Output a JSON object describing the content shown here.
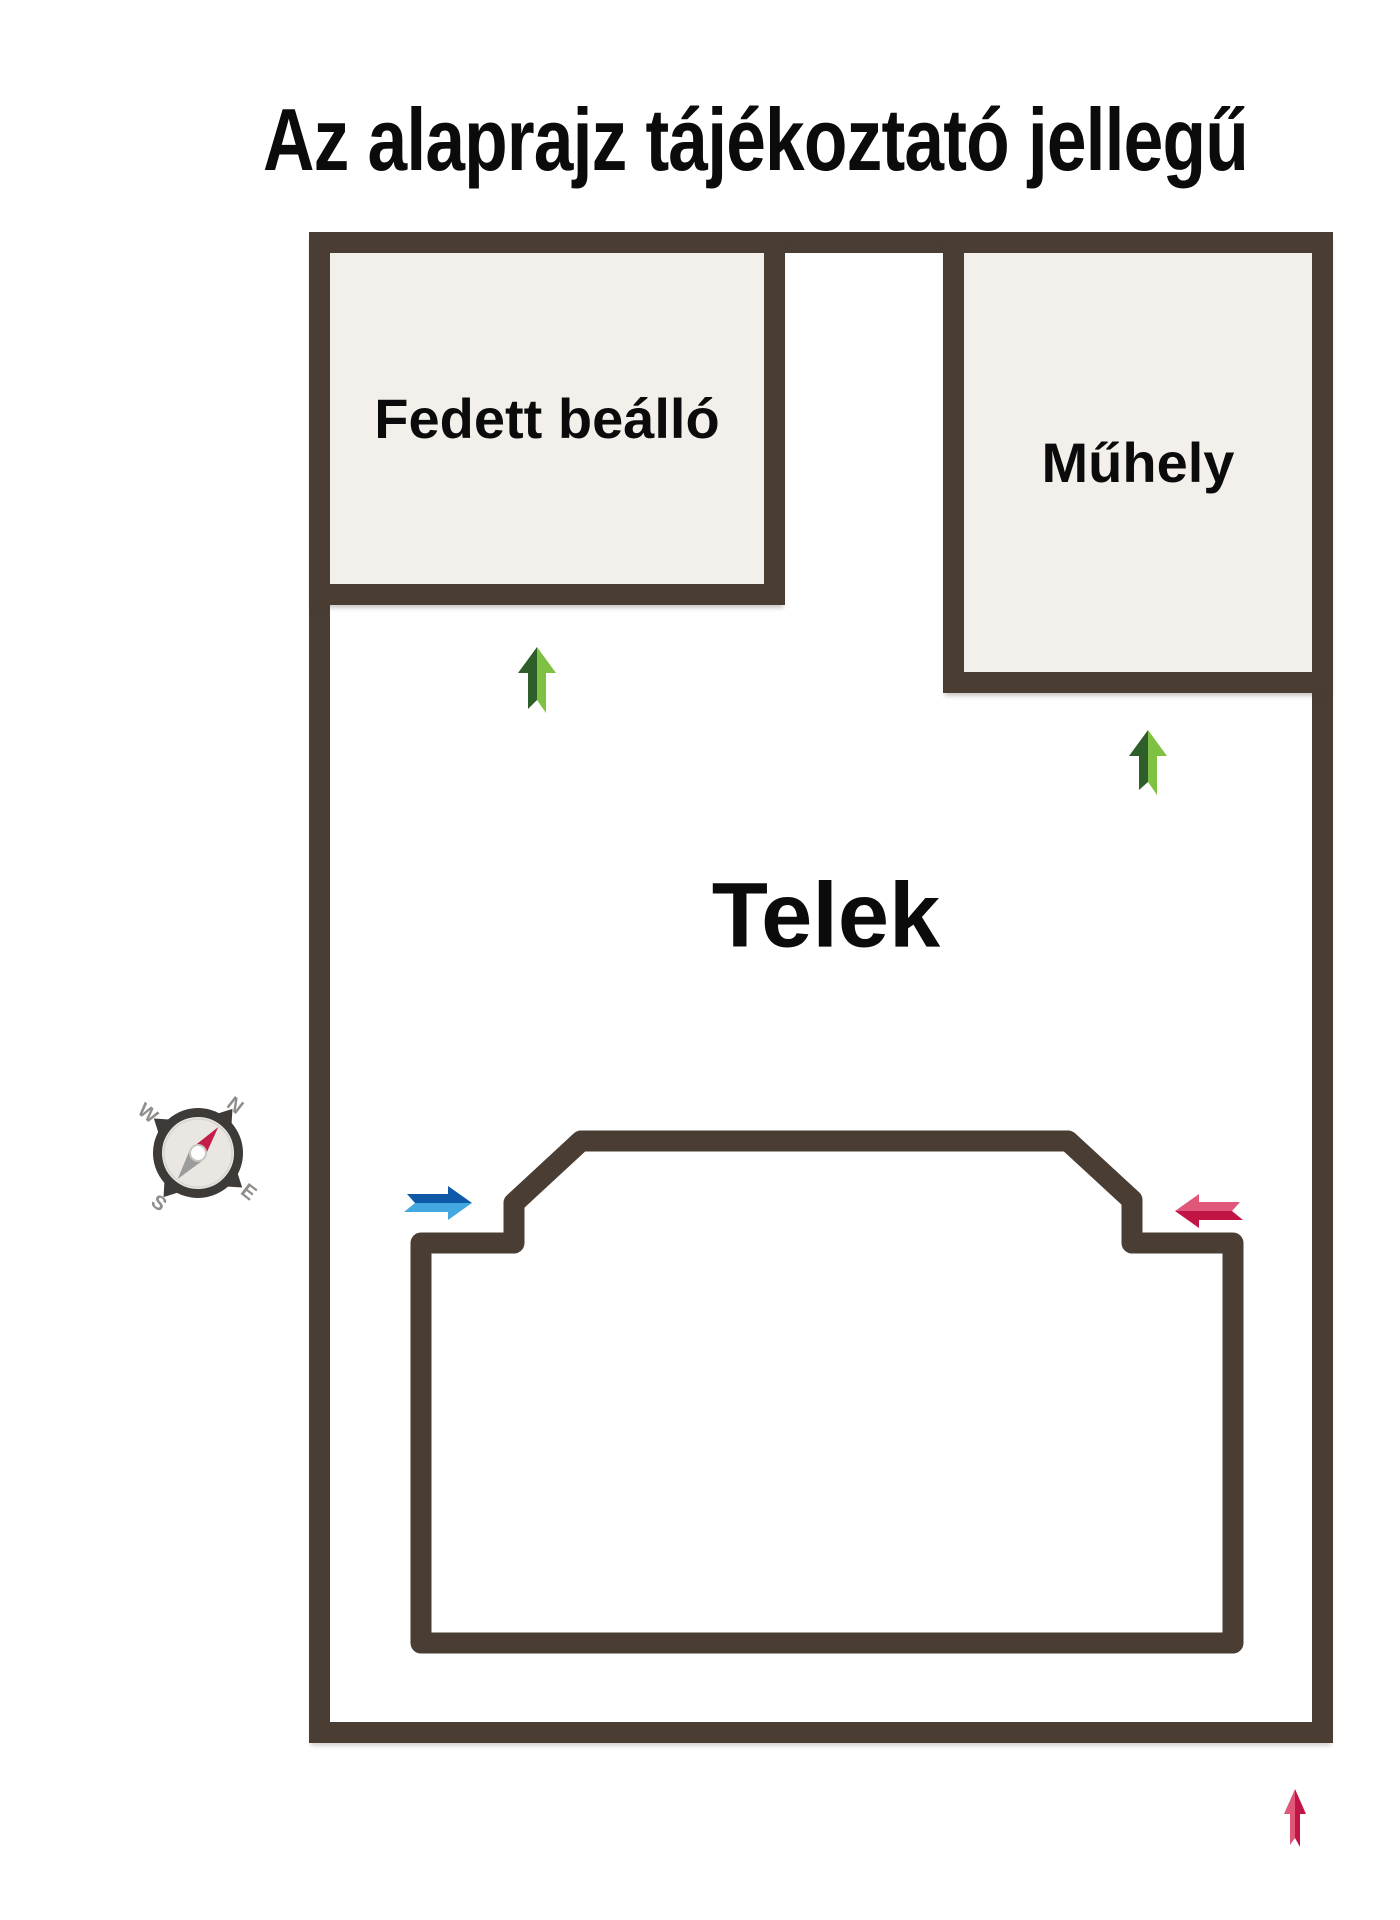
{
  "title": "Az alaprajz tájékoztató jellegű",
  "rooms": {
    "carport": {
      "label": "Fedett beálló"
    },
    "workshop": {
      "label": "Műhely"
    },
    "plot": {
      "label": "Telek"
    },
    "house": {
      "label": "Ház"
    }
  },
  "compass": {
    "n": "N",
    "e": "E",
    "s": "S",
    "w": "W",
    "rotation_deg": 38
  },
  "arrows": {
    "carport_entry": {
      "direction": "up",
      "color_scheme": "green"
    },
    "workshop_entry": {
      "direction": "up",
      "color_scheme": "green"
    },
    "house_left_entry": {
      "direction": "right",
      "color_scheme": "blue"
    },
    "house_right_entry": {
      "direction": "left",
      "color_scheme": "red"
    },
    "plot_bottom_marker": {
      "direction": "up",
      "color_scheme": "red"
    }
  },
  "colors": {
    "background": "#ffffff",
    "wall": "#4a3d33",
    "room_fill": "#f3f0ec",
    "text": "#0b0b0b",
    "arrow_green_dark": "#2e5f2a",
    "arrow_green_light": "#7fc142",
    "arrow_blue_dark": "#0e59a8",
    "arrow_blue_light": "#44a8e0",
    "arrow_red_light": "#e0577a",
    "arrow_red_dark": "#c01545",
    "needle_north": "#c41d4a",
    "needle_south": "#9b9b9b",
    "compass_ring": "#3d3a38",
    "compass_face": "#eae7e3"
  }
}
